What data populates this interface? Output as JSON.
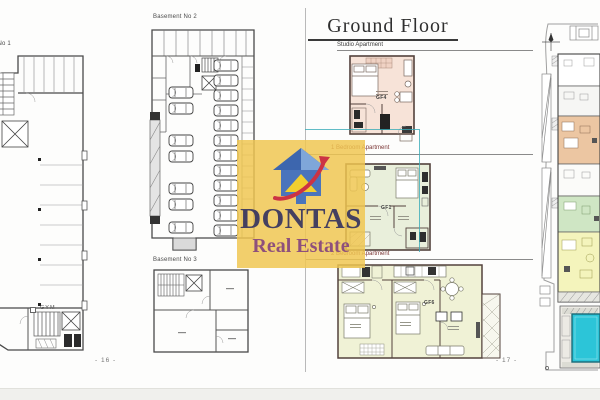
{
  "left": {
    "plan1_label": "Basement No 1",
    "plan2_label": "Basement No 2",
    "plan3_label": "Basement No 3",
    "gym_label": "GYM",
    "page_number": "- 16 -"
  },
  "right": {
    "title": "Ground Floor",
    "studio_label": "Studio Apartment",
    "studio_unit": "GF4",
    "one_bed_label": "1 Bedroom Apartment",
    "one_bed_unit": "GF1",
    "two_bed_label": "2 Bedroom Apartment",
    "two_bed_unit": "GF6",
    "page_number": "- 17 -"
  },
  "watermark": {
    "name": "DONTAS",
    "subtitle": "Real Estate"
  },
  "colors": {
    "studio_fill": "#f7e3d8",
    "one_bed_fill": "#e9efdb",
    "two_bed_fill": "#f0f2d6",
    "site_unit_orange": "#ecc6a2",
    "site_unit_green": "#cfe6c4",
    "site_unit_yellow": "#f4f4bc",
    "pool_water": "#2cc5d8",
    "watermark_bg": "#f0c650",
    "watermark_name_color": "#454060",
    "watermark_subtitle_color": "#8e507c",
    "section_label_color": "#7b3535",
    "highlight_color": "#3aabb8"
  }
}
